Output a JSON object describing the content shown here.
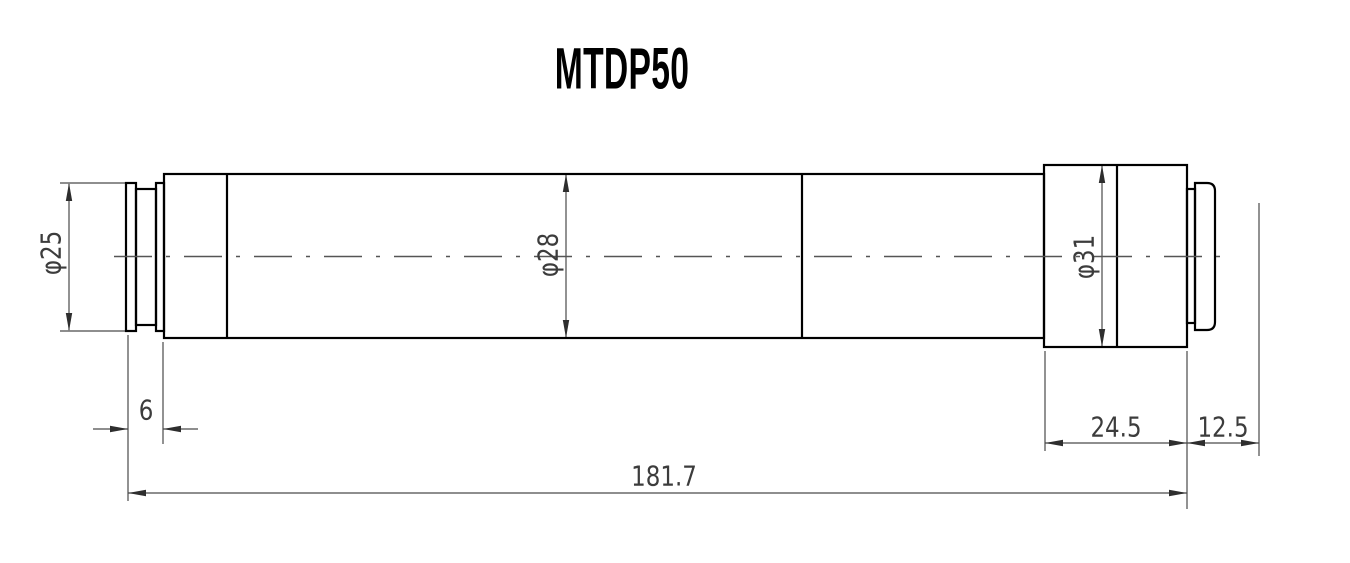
{
  "title": "MTDP50",
  "dimensions": {
    "front_diameter": "φ25",
    "mid_diameter": "φ28",
    "rear_diameter": "φ31",
    "front_step_length": "6",
    "rear_section_length": "24.5",
    "back_flange_distance": "12.5",
    "overall_length": "181.7"
  },
  "colors": {
    "object_line": "#000000",
    "dimension_line": "#4a4a4a",
    "centerline": "#555555",
    "text": "#3c3c3c",
    "background": "#ffffff"
  }
}
